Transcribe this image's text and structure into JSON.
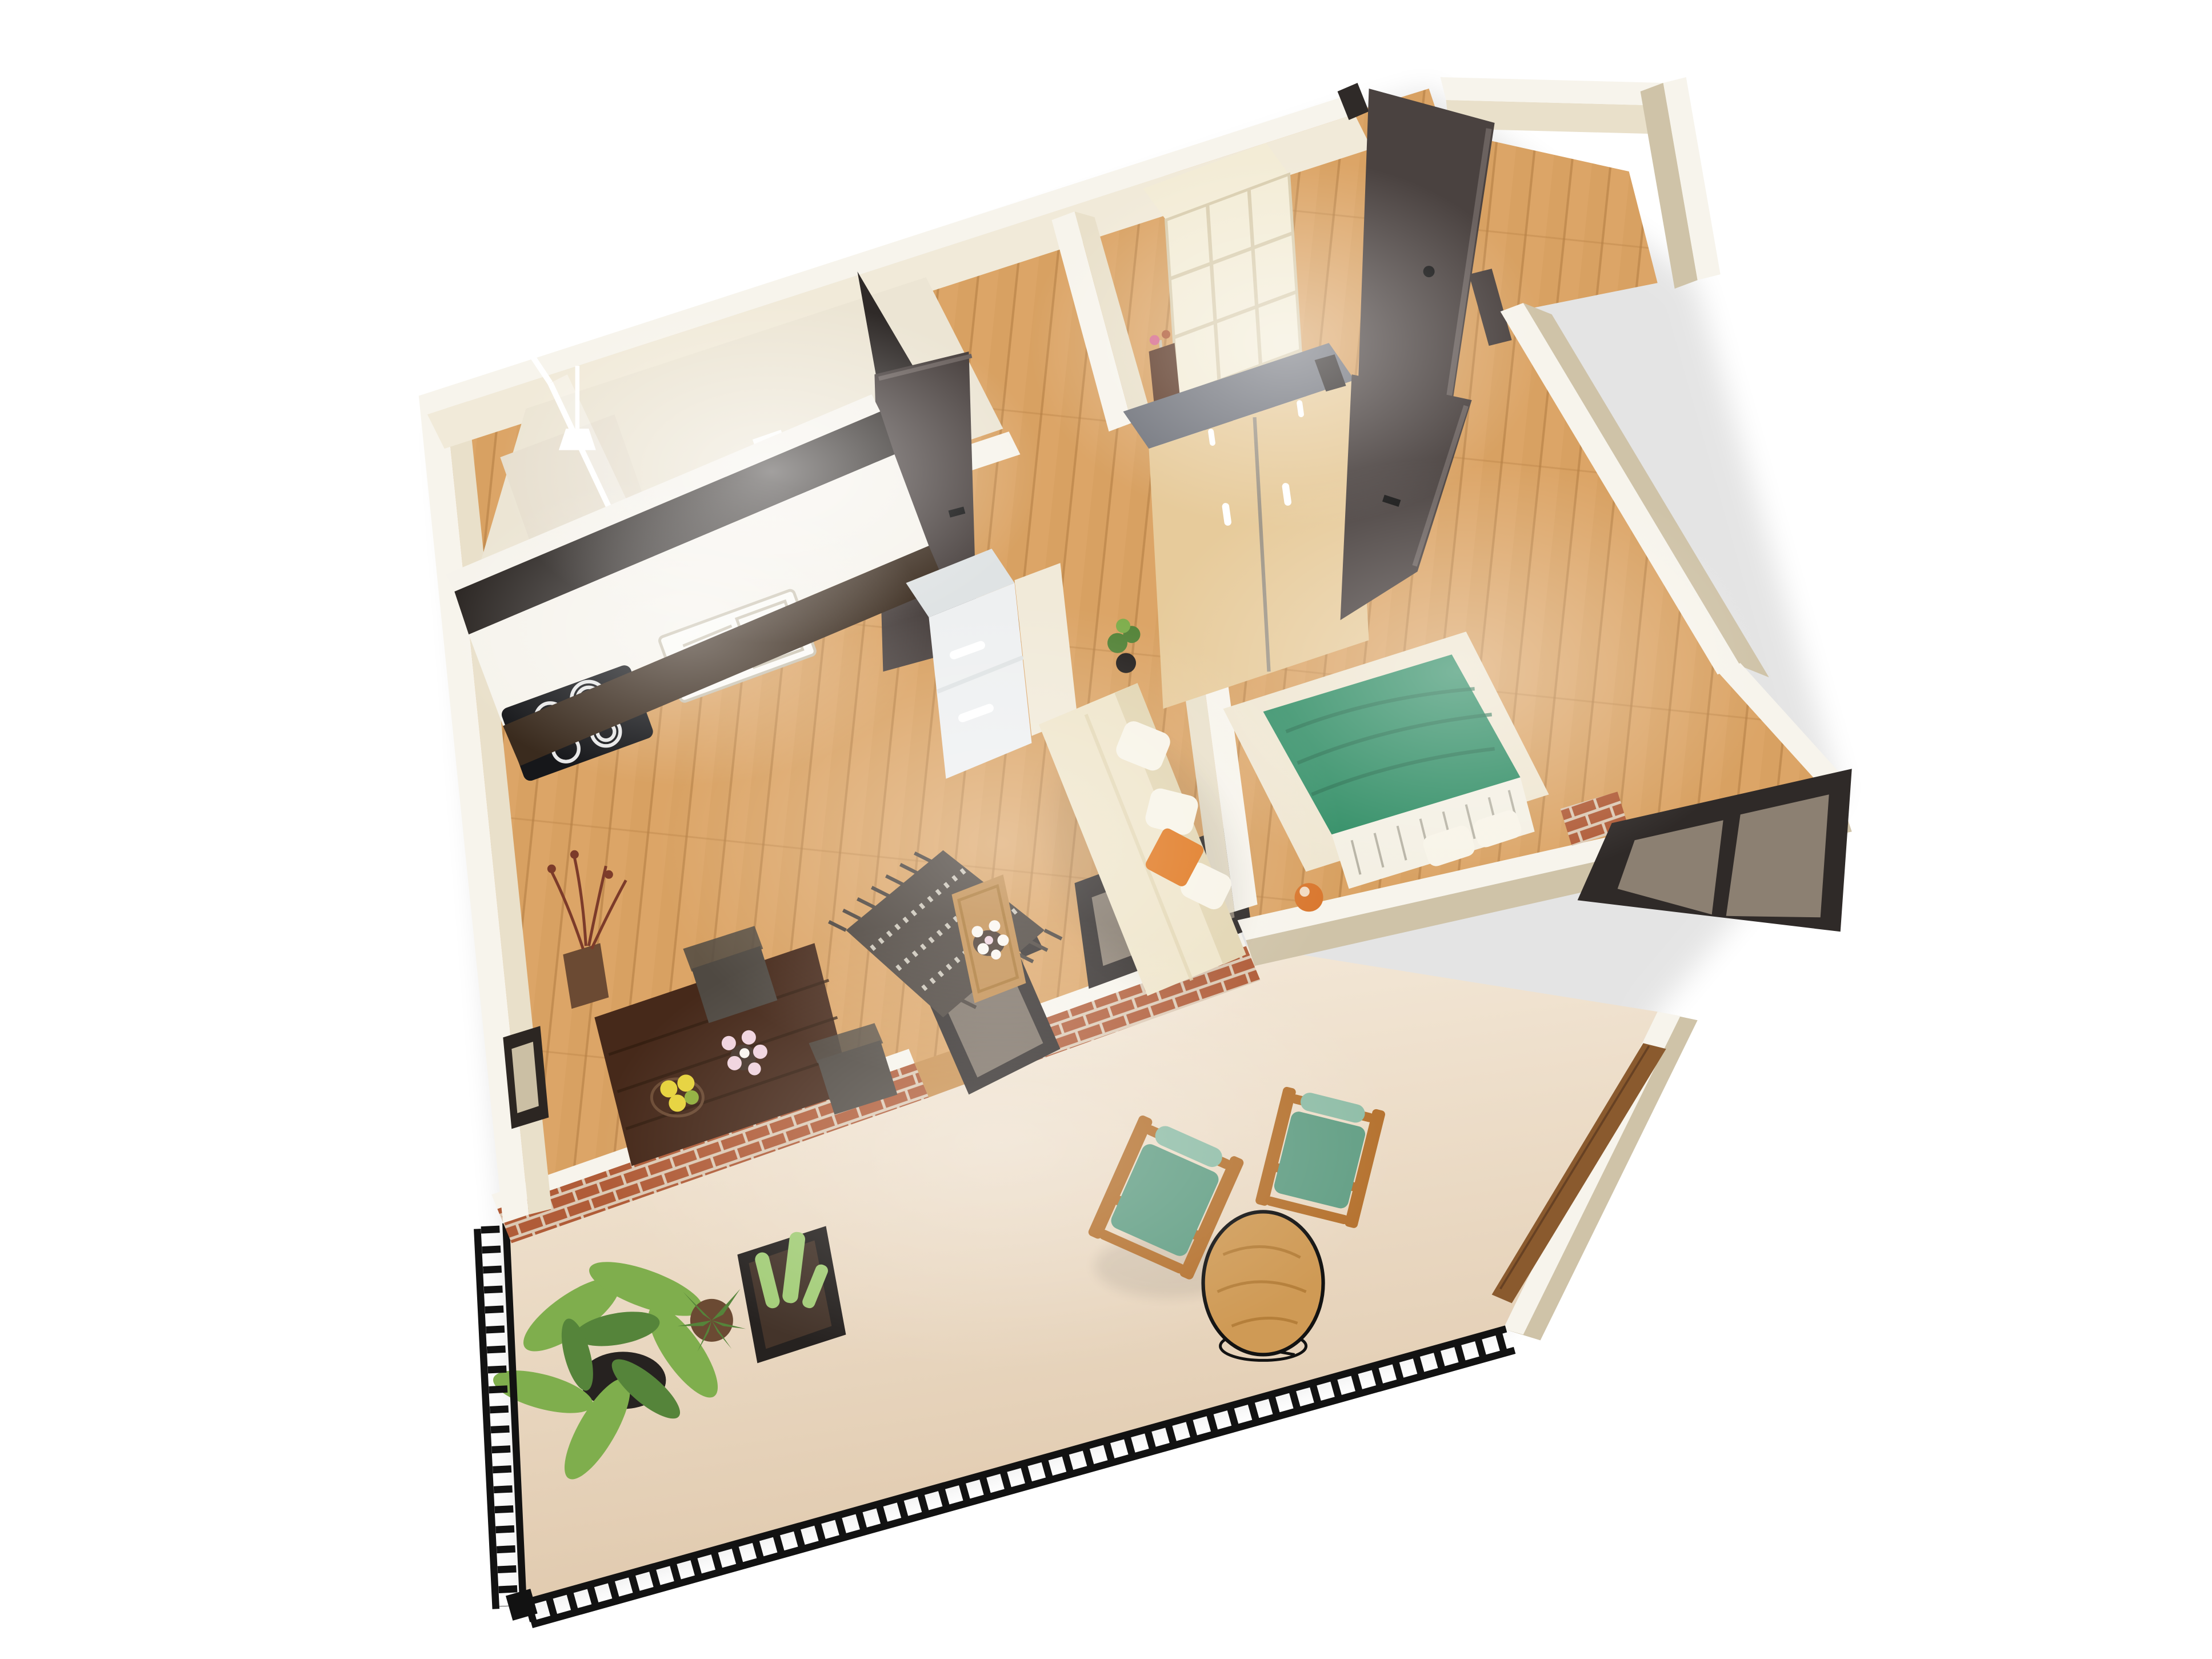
{
  "scene": {
    "kind": "isometric-3d-floorplan-render",
    "description": "Bird's-eye 3D render of a one-bedroom apartment with open-plan kitchen and living room, bathroom, entrance hall, bedroom and a large balcony",
    "background": "#ffffff"
  },
  "palette": {
    "background": "#ffffff",
    "wall_top": "#f7f4ec",
    "wall_face": "#cfc3a8",
    "wall_face_light": "#e9e0ca",
    "wall_face_bright": "#f1ead9",
    "floor_wood": "#dca567",
    "floor_wood_dark": "#c9904f",
    "plank_line": "#b37c42",
    "balcony_floor": "#f6ecdd",
    "balcony_floor_shade": "#e0c9ad",
    "brick": "#b05c38",
    "brick_mortar": "#dcc9b4",
    "railing": "#121212",
    "door_dark": "#4a4240",
    "door_dark_edge": "#6b625f",
    "glass": "#d9c6ae",
    "glass_frame": "#2f2a28",
    "counter_white": "#f6f3ec",
    "cabinet_black": "#2b2623",
    "cabinet_base_brown": "#3a2b1e",
    "hob_black": "#16171a",
    "hob_ring": "#e8e8e8",
    "sink_white": "#fbfaf6",
    "sink_line": "#c9c2b0",
    "fridge_white": "#eef0f1",
    "fridge_side": "#dfe3e4",
    "bath_floor": "#ece5d4",
    "shower_tray": "#e7dfcf",
    "porcelain": "#fdfdfb",
    "porcelain_shadow": "#d8d2c0",
    "shelf_cream": "#f3ecd6",
    "shelf_line": "#d9cdae",
    "coat_brown": "#5d3a28",
    "shoe_black": "#1c1c1e",
    "shoe_pink": "#d66a8c",
    "wardrobe_wood": "#e7cb9b",
    "wardrobe_top": "#70737b",
    "handle_white": "#ffffff",
    "bed_green": "#2e8c63",
    "bed_green_dark": "#1f6b4a",
    "sheet_white": "#f4f0e4",
    "sheet_stripe": "#a9a496",
    "bed_rug": "#efe6d1",
    "lamp_orange": "#d9772e",
    "sofa_cream": "#efe5ca",
    "sofa_back": "#e2d5b2",
    "pillow_white": "#f8f4e8",
    "pillow_orange": "#e0771e",
    "rug_dark": "#463e37",
    "rug_dot": "#d8d2c4",
    "tray_wood": "#c08a4a",
    "table_walnut": "#46291a",
    "table_walnut_line": "#331d10",
    "chair_cushion": "#4f4942",
    "deck_wood": "#b5722f",
    "deck_green": "#639f85",
    "deck_green_light": "#8fbda7",
    "round_table_wood": "#cf9a55",
    "round_table_grain": "#a9742f",
    "bench_wood": "#8a5a2e",
    "plant_green": "#7fae4d",
    "plant_green_dark": "#55843a",
    "cactus_green": "#a3cd78",
    "pot_black": "#262220",
    "pot_brown": "#6b4a33",
    "soil_brown": "#44342a",
    "branch_red": "#7c3b2a",
    "lemon_yellow": "#e6d23a",
    "lime_green": "#8fae3a",
    "flower_pink": "#f0d3de",
    "flower_white": "#faf6f0",
    "frame_dark": "#2c2622",
    "frame_canvas": "#cbbfa4",
    "shadow": "#000000"
  },
  "rooms": [
    {
      "id": "kitchen",
      "label": "kitchen",
      "furniture": [
        "induction-hob",
        "sink",
        "fridge",
        "black-upper-cabinets",
        "dark-base-cabinets",
        "pendant-lamp"
      ]
    },
    {
      "id": "bathroom",
      "label": "bathroom",
      "furniture": [
        "toilet",
        "shower-glass-screen",
        "toilet-paper-holder",
        "flush-plate"
      ]
    },
    {
      "id": "hall",
      "label": "entrance hall",
      "furniture": [
        "cube-shelf-with-shoes",
        "coat-rack",
        "entrance-door"
      ]
    },
    {
      "id": "living-dining",
      "label": "living and dining room",
      "furniture": [
        "cream-sofa",
        "orange-pillow",
        "striped-dark-rug",
        "wood-coffee-tray",
        "walnut-dining-table",
        "two-chairs",
        "lemon-bowl",
        "flower-vase",
        "picture-frame",
        "dried-branch-vase",
        "balcony-glass-door",
        "fixed-window"
      ]
    },
    {
      "id": "bedroom",
      "label": "bedroom",
      "furniture": [
        "double-bed-green-duvet",
        "white-pillows",
        "cream-rug",
        "wardrobe",
        "orange-lamp",
        "bedroom-door",
        "tilted-window"
      ]
    },
    {
      "id": "balcony",
      "label": "balcony",
      "furniture": [
        "two-green-deck-chairs",
        "round-wood-table",
        "wood-bench",
        "big-leaf-plant",
        "aloe-pot",
        "cactus-planter",
        "black-metal-railing",
        "brick-parapet"
      ]
    }
  ]
}
